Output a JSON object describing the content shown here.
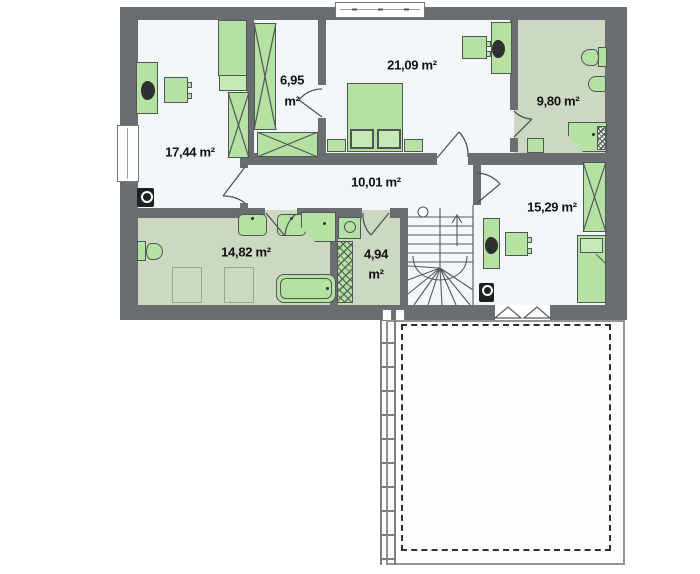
{
  "plan": {
    "type": "floor-plan-upper-storey",
    "unit": "m²",
    "rooms": [
      {
        "name": "bedroom-left",
        "area": "17,44 m²"
      },
      {
        "name": "walkin-closet",
        "area_line1": "6,95",
        "area_line2": "m²"
      },
      {
        "name": "bedroom-main",
        "area": "21,09 m²"
      },
      {
        "name": "bathroom-top",
        "area": "9,80 m²"
      },
      {
        "name": "hall",
        "area": "10,01 m²"
      },
      {
        "name": "bedroom-right",
        "area": "15,29 m²"
      },
      {
        "name": "bathroom-main",
        "area": "14,82 m²"
      },
      {
        "name": "utility-room",
        "area_line1": "4,94",
        "area_line2": "m²"
      }
    ],
    "colors": {
      "wall": "#6b6e71",
      "floor": "#f3f7fa",
      "floor_green": "#ccd8c2",
      "furniture": "#b5e1a3",
      "furniture_line": "#4f5756",
      "text": "#101010",
      "terrace_dash": "#2f2f2f"
    }
  }
}
